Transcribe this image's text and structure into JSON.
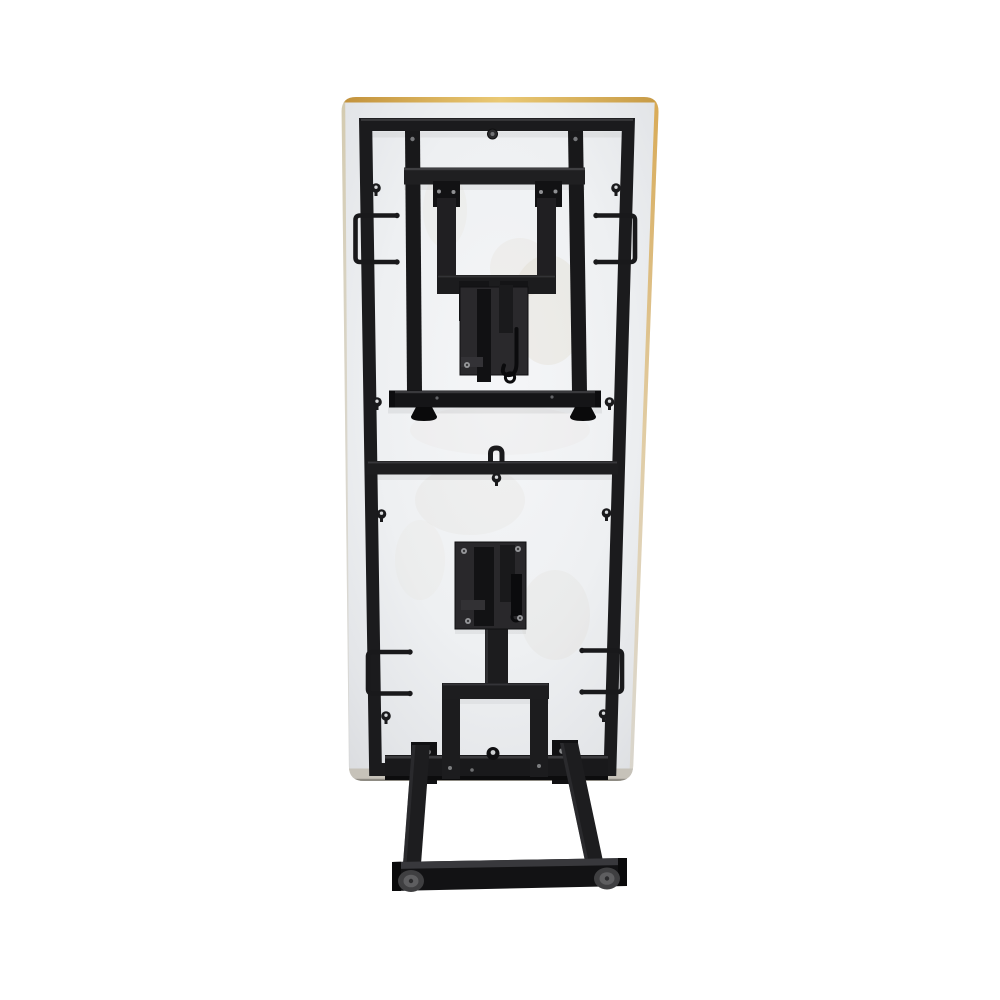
{
  "image": {
    "type": "product-photo",
    "subject": "Underside view of a rectangular folding table standing upright: white laminate top with gold edge banding, black steel perimeter frame, one folding leg locked flat against the top and a second folding leg partially unfolded toward the floor with a cross foot bar and round feet",
    "background_color": "#ffffff",
    "colors": {
      "tabletop_surface": "#eef0f2",
      "edge_banding_gold": "#d9a84e",
      "bottom_edge_band": "#c6c2b9",
      "steel_frame": "#1b1b1d",
      "hinge_plate": "#29282b",
      "foot_cap_outer": "#3f3f41",
      "foot_cap_inner": "#5e5e60",
      "screw_head": "#96979a"
    },
    "parts": {
      "tabletop": "white laminate tabletop seen from below",
      "perimeter_frame": "black steel perimeter frame with slight perspective taper",
      "center_rail": "horizontal center cross rail with wire clip and keyhole fitting",
      "upper_folded_leg": "folded leg with two long tubes, cross member, folding brace frame, lock plate with latch hook, floor bar and two pad feet",
      "lower_extended_leg": "partially unfolded leg with hinge lock plate, brace frame, two angled tubes, cross floor bar and two round foot caps",
      "wire_brackets": "four black wire retaining brackets on the side rails",
      "keyhole_fittings": "eight keyhole screw fittings in pairs along the side rails",
      "screws": "bright screw and bolt heads on hinge plates and brackets"
    }
  }
}
